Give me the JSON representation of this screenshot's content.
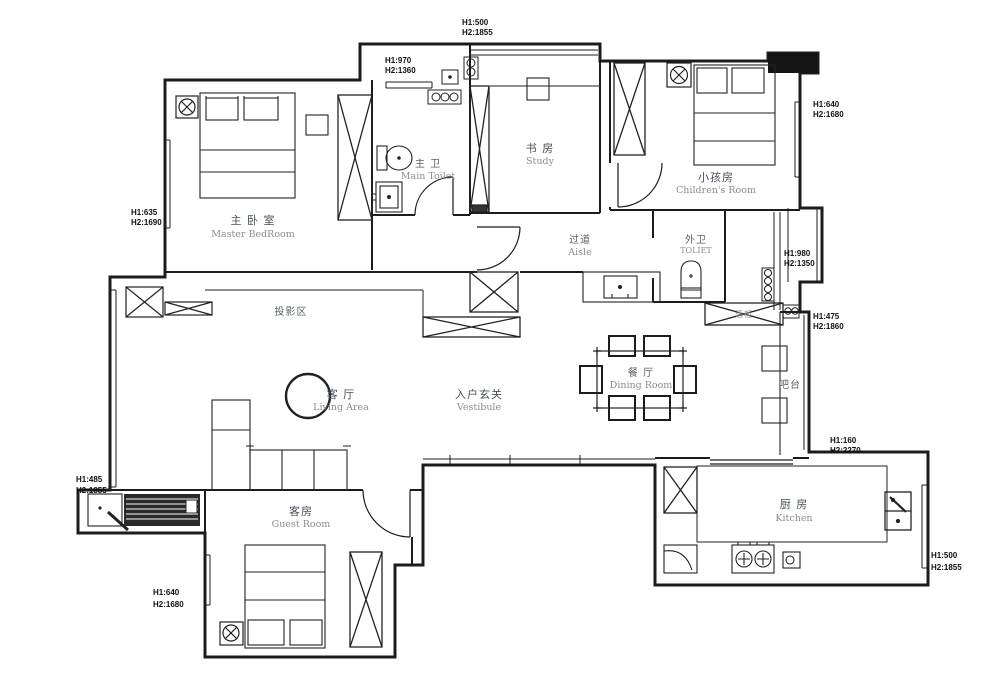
{
  "plan": {
    "rooms": {
      "master_bedroom": {
        "zh": "主 卧 室",
        "en": "Master BedRoom"
      },
      "main_toilet": {
        "zh": "主 卫",
        "en": "Main Toilet"
      },
      "study": {
        "zh": "书 房",
        "en": "Study"
      },
      "aisle": {
        "zh": "过道",
        "en": "Aisle"
      },
      "children_room": {
        "zh": "小孩房",
        "en": "Children's Room"
      },
      "outer_toilet": {
        "zh": "外卫",
        "en": "TOLIET"
      },
      "projection_area": {
        "zh": "投影区"
      },
      "living_area": {
        "zh": "客 厅",
        "en": "Living Area"
      },
      "vestibule": {
        "zh": "入户玄关",
        "en": "Vestibule"
      },
      "dining_room": {
        "zh": "餐 厅",
        "en": "Dining Room"
      },
      "bar_counter": {
        "zh": "吧台"
      },
      "kitchen": {
        "zh": "厨 房",
        "en": "Kitchen"
      },
      "guest_room": {
        "zh": "客房",
        "en": "Guest Room"
      },
      "wine_cabinet": {
        "zh": "酒柜"
      }
    },
    "dims": {
      "top_study": {
        "h1": "H1:500",
        "h2": "H2:1855"
      },
      "toilet_window": {
        "h1": "H1:970",
        "h2": "H2:1360"
      },
      "master_west": {
        "h1": "H1:635",
        "h2": "H2:1690"
      },
      "children_east": {
        "h1": "H1:640",
        "h2": "H2:1680"
      },
      "bay_east": {
        "h1": "H1:980",
        "h2": "H2:1350"
      },
      "bar_east": {
        "h1": "H1:475",
        "h2": "H2:1860"
      },
      "kitchen_north": {
        "h1": "H1:160",
        "h2": "H2:2270"
      },
      "kitchen_east": {
        "h1": "H1:500",
        "h2": "H2:1855"
      },
      "living_west": {
        "h1": "H1:485",
        "h2": "H2:1855"
      },
      "guest_west": {
        "h1": "H1:640",
        "h2": "H2:1680"
      }
    },
    "colors": {
      "wall": "#1c1c1c",
      "label_zh": "#46505a",
      "label_en": "#8c8c8c",
      "dim": "#111111"
    }
  }
}
